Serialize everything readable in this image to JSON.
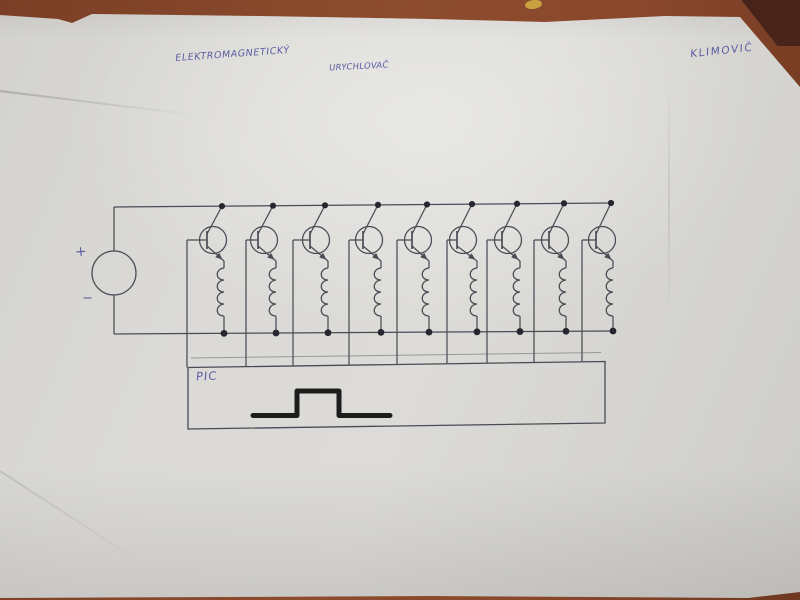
{
  "title": {
    "line1": "ELEKTROMAGNETICKÝ",
    "line2": "URYCHLOVAČ"
  },
  "author": "KLIMOVIČ",
  "source_labels": {
    "plus": "+",
    "minus": "−"
  },
  "controller_label": "PIC",
  "colors": {
    "ink_blue": "#4f529e",
    "pencil": "#4b4b55",
    "junction_dot": "#26262e",
    "pulse": "#1d1d1d",
    "paper": "#d8d7d3",
    "table": "#8a482c"
  },
  "diagram": {
    "stage_count": 9,
    "top_rail": {
      "x1": 114,
      "y1": 207,
      "x2": 611,
      "y2": 203
    },
    "bottom_rail": {
      "x1": 114,
      "y1": 334,
      "x2": 613,
      "y2": 331
    },
    "source": {
      "cx": 114,
      "cy": 273,
      "r": 22
    },
    "transistor": {
      "cy": 240,
      "r": 13.5
    },
    "coil": {
      "top": 268,
      "loops": 4,
      "loop_h": 12,
      "bulge": 9
    },
    "stages": [
      {
        "top_x": 222,
        "bot_x": 224,
        "base_x": 187
      },
      {
        "top_x": 273,
        "bot_x": 276,
        "base_x": 246
      },
      {
        "top_x": 325,
        "bot_x": 328,
        "base_x": 293
      },
      {
        "top_x": 378,
        "bot_x": 381,
        "base_x": 349
      },
      {
        "top_x": 427,
        "bot_x": 429,
        "base_x": 397
      },
      {
        "top_x": 472,
        "bot_x": 477,
        "base_x": 447
      },
      {
        "top_x": 517,
        "bot_x": 520,
        "base_x": 487
      },
      {
        "top_x": 564,
        "bot_x": 566,
        "base_x": 534
      },
      {
        "top_x": 611,
        "bot_x": 613,
        "base_x": 582
      }
    ],
    "pic_box": {
      "points": "188,367.5 605,361.5 605,423 188,429",
      "ghost_line": [
        191,
        358,
        601,
        352.5
      ]
    },
    "pulse_path": "M253 415.5 L297 415.5 L297 391 L339 391 L339 415.5 L390 415.5"
  }
}
